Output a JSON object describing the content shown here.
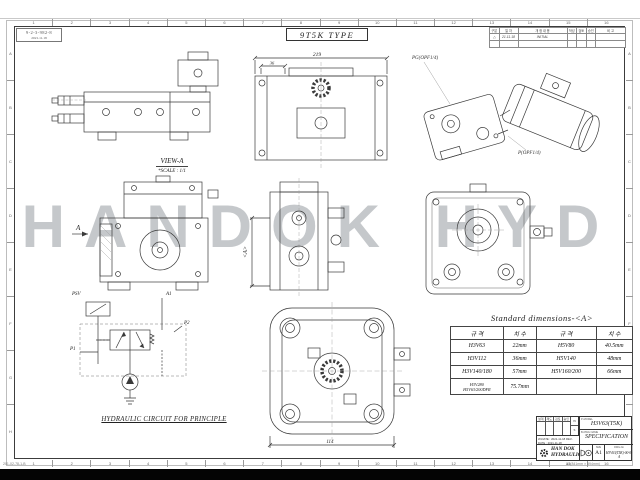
{
  "page": {
    "watermark": "HANDOK HYD",
    "form_no": "201-02-78-1-B",
    "size_note": "A1(841mm × 594mm)"
  },
  "stamp": {
    "line1": "9-2-3-982-8",
    "line2": "2021.11.18"
  },
  "type_box": {
    "label": "9T5K TYPE"
  },
  "ruler": {
    "numbers": [
      "1",
      "2",
      "3",
      "4",
      "5",
      "6",
      "7",
      "8",
      "9",
      "10",
      "11",
      "12",
      "13",
      "14",
      "15",
      "16"
    ],
    "letters": [
      "A",
      "B",
      "C",
      "D",
      "E",
      "F",
      "G",
      "H"
    ]
  },
  "rev_table": {
    "headers": [
      "구분",
      "일 자",
      "개 정 내 용",
      "작성",
      "검토",
      "승인",
      "비 고"
    ],
    "rows": [
      [
        "△",
        "21.11.18",
        "INITIAL",
        "",
        "",
        "",
        ""
      ],
      [
        "",
        "",
        "",
        "",
        "",
        "",
        ""
      ]
    ]
  },
  "views": {
    "view_a": {
      "title": "VIEW-A",
      "scale": "*SCALE : 1/1"
    },
    "front": {
      "dim_width": "219",
      "dim_left": "36"
    },
    "iso": {
      "port_pg": "PG(OPF1/4)",
      "port_p": "P(OPF1/4)"
    },
    "side": {
      "arrow": "A"
    },
    "center": {
      "dim_a": "<A>"
    },
    "top": {
      "dim_width": "114"
    }
  },
  "circuit": {
    "psv": "PSV",
    "a1": "A1",
    "p2": "P2",
    "p1": "P1",
    "caption": "HYDRAULIC CIRCUIT FOR PRINCIPLE"
  },
  "dims_table": {
    "title": "Standard dimensions-<A>",
    "headers": [
      "규 격",
      "치 수",
      "규 격",
      "치 수"
    ],
    "rows": [
      [
        "H3V63",
        "22mm",
        "H5V80",
        "40.5mm"
      ],
      [
        "H3V112",
        "36mm",
        "H5V140",
        "48mm"
      ],
      [
        "H3V140/180",
        "57mm",
        "H5V160/200",
        "66mm"
      ],
      [
        "H3V280\nH5V63/200DFR",
        "75.7mm",
        "",
        ""
      ]
    ]
  },
  "title_block": {
    "approvals": [
      "설계",
      "제도",
      "검토",
      "승인"
    ],
    "scale_top": "N",
    "scale_bottom": "S",
    "date_line": "W-DATE : 2021-11-18   REV-DATE : 2021-11-18",
    "model_label": "P-MODEL",
    "model": "H3V63(T5K)",
    "name_label": "B-DWG NAME",
    "name": "SPECIFICATION",
    "company_line1": "HAN DOK",
    "company_line2": "HYDRAULIC",
    "size_label": "SIZE",
    "size": "A1",
    "dwgno_label": "DWG-No",
    "dwg_no": "H3V63(T5K)-00-0-A"
  }
}
